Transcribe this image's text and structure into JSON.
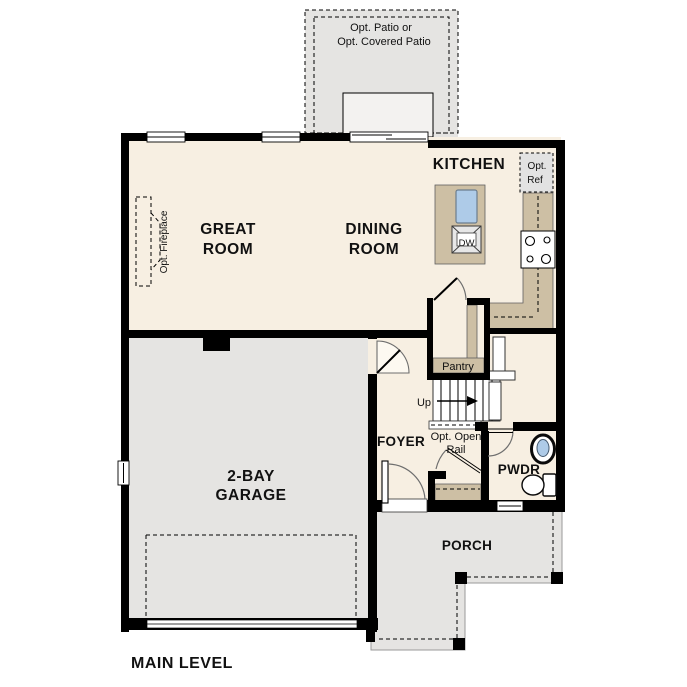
{
  "plan_title": "MAIN LEVEL",
  "rooms": {
    "patio": {
      "line1": "Opt. Patio or",
      "line2": "Opt. Covered Patio"
    },
    "kitchen": {
      "label": "KITCHEN"
    },
    "great_room": {
      "line1": "GREAT",
      "line2": "ROOM"
    },
    "dining_room": {
      "line1": "DINING",
      "line2": "ROOM"
    },
    "pantry": {
      "label": "Pantry"
    },
    "foyer": {
      "label": "FOYER"
    },
    "powder_room": {
      "label": "PWDR"
    },
    "garage": {
      "line1": "2-BAY",
      "line2": "GARAGE"
    },
    "porch": {
      "label": "PORCH"
    }
  },
  "annotations": {
    "fireplace": "Opt. Fireplace",
    "fridge_line1": "Opt.",
    "fridge_line2": "Ref",
    "dishwasher": "DW",
    "stairs_direction": "Up",
    "open_rail_line1": "Opt. Open",
    "open_rail_line2": "Rail"
  },
  "colors": {
    "wall": "#000000",
    "interior_floor": "#f7efe2",
    "exterior_surface": "#e5e4e2",
    "cabinetry": "#cdbfa4",
    "sink_fill": "#aecbe8"
  }
}
